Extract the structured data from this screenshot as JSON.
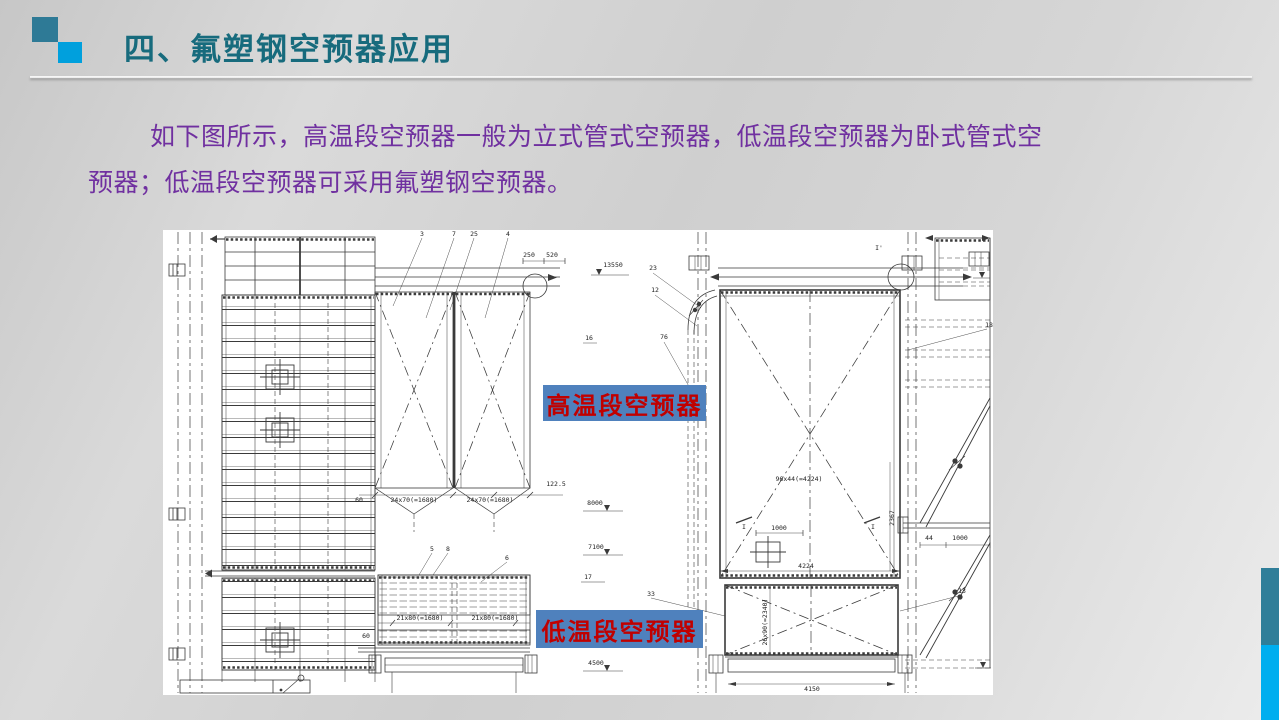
{
  "slide": {
    "title": "四、氟塑钢空预器应用",
    "body": {
      "lines": [
        "如下图所示，高温段空预器一般为立式管式空预器，低温段空预器为卧式管式空",
        "预器；低温段空预器可采用氟塑钢空预器。"
      ]
    }
  },
  "overlay_labels": {
    "high_temp": "高温段空预器",
    "low_temp": "低温段空预器"
  },
  "colors": {
    "title-text": "#176b7d",
    "body-text": "#7030a0",
    "label-bg": "#4f81bd",
    "label-text": "#c00000",
    "square-teal": "#2e7a96",
    "square-blue": "#00a0dd",
    "bar-teal": "#2f7e99",
    "bar-blue": "#00aeef",
    "drawing-line": "#3a3a3a"
  },
  "drawing": {
    "annotations": [
      {
        "x": 259,
        "y": 6,
        "t": "3"
      },
      {
        "x": 291,
        "y": 6,
        "t": "7"
      },
      {
        "x": 311,
        "y": 6,
        "t": "25"
      },
      {
        "x": 345,
        "y": 6,
        "t": "4"
      },
      {
        "x": 366,
        "y": 27,
        "t": "250"
      },
      {
        "x": 389,
        "y": 27,
        "t": "520"
      },
      {
        "x": 450,
        "y": 37,
        "t": "13550"
      },
      {
        "x": 490,
        "y": 40,
        "t": "23"
      },
      {
        "x": 492,
        "y": 62,
        "t": "12"
      },
      {
        "x": 426,
        "y": 110,
        "t": "16"
      },
      {
        "x": 501,
        "y": 109,
        "t": "76"
      },
      {
        "x": 196,
        "y": 272,
        "t": "60"
      },
      {
        "x": 251,
        "y": 272,
        "t": "24x70(=1680)"
      },
      {
        "x": 327,
        "y": 272,
        "t": "24x70(=1680)"
      },
      {
        "x": 393,
        "y": 256,
        "t": "122.5"
      },
      {
        "x": 269,
        "y": 321,
        "t": "5"
      },
      {
        "x": 285,
        "y": 321,
        "t": "8"
      },
      {
        "x": 344,
        "y": 330,
        "t": "6"
      },
      {
        "x": 257,
        "y": 390,
        "t": "21x80(=1680)"
      },
      {
        "x": 332,
        "y": 390,
        "t": "21x80(=1680)"
      },
      {
        "x": 203,
        "y": 408,
        "t": "60"
      },
      {
        "x": 432,
        "y": 275,
        "t": "8000"
      },
      {
        "x": 433,
        "y": 319,
        "t": "7100"
      },
      {
        "x": 425,
        "y": 349,
        "t": "17"
      },
      {
        "x": 433,
        "y": 435,
        "t": "4500"
      },
      {
        "x": 636,
        "y": 251,
        "t": "96x44(=4224)"
      },
      {
        "x": 616,
        "y": 300,
        "t": "1000"
      },
      {
        "x": 643,
        "y": 338,
        "t": "4224"
      },
      {
        "x": 731,
        "y": 288,
        "t": "2367",
        "r": -90
      },
      {
        "x": 604,
        "y": 392,
        "t": "26x90(=2340)",
        "r": -90
      },
      {
        "x": 649,
        "y": 461,
        "t": "4150"
      },
      {
        "x": 488,
        "y": 366,
        "t": "33"
      },
      {
        "x": 799,
        "y": 363,
        "t": "13"
      },
      {
        "x": 826,
        "y": 97,
        "t": "18"
      },
      {
        "x": 766,
        "y": 310,
        "t": "44"
      },
      {
        "x": 797,
        "y": 310,
        "t": "1000"
      },
      {
        "x": 716,
        "y": 20,
        "t": "I'"
      },
      {
        "x": 581,
        "y": 299,
        "t": "I"
      },
      {
        "x": 710,
        "y": 299,
        "t": "I"
      }
    ]
  }
}
